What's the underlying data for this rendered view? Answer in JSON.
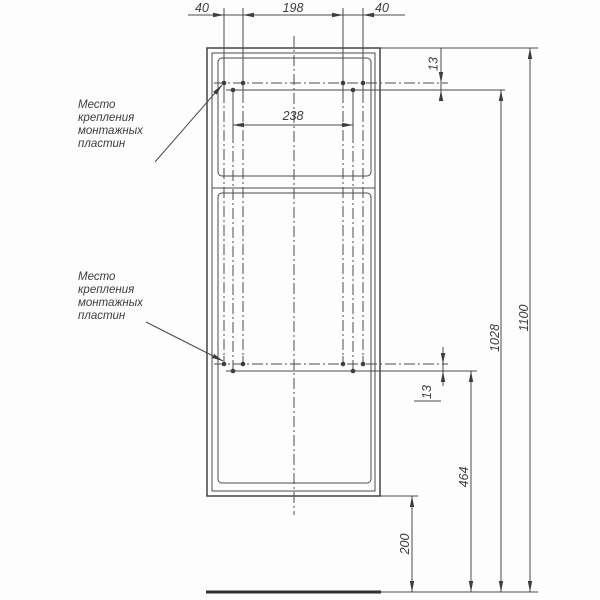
{
  "drawing": {
    "type": "technical-front-view",
    "subject": "cabinet mounting diagram",
    "units": "mm",
    "colors": {
      "line": "#4a4a4a",
      "text": "#3d3d3d",
      "ground_line": "#303030",
      "background": "#fdfdfd"
    }
  },
  "notes": {
    "mount_note": {
      "lines": [
        "Место",
        "крепления",
        "монтажных",
        "пластин"
      ]
    }
  },
  "dimensions": {
    "top_left": "40",
    "top_center": "198",
    "top_right": "40",
    "mount_hole_spacing": "238",
    "mount_offset_top": "13",
    "mount_offset_bottom": "13",
    "total_height": "1100",
    "upper_mount_height": "1028",
    "lower_mount_height": "464",
    "bottom_clearance": "200"
  }
}
